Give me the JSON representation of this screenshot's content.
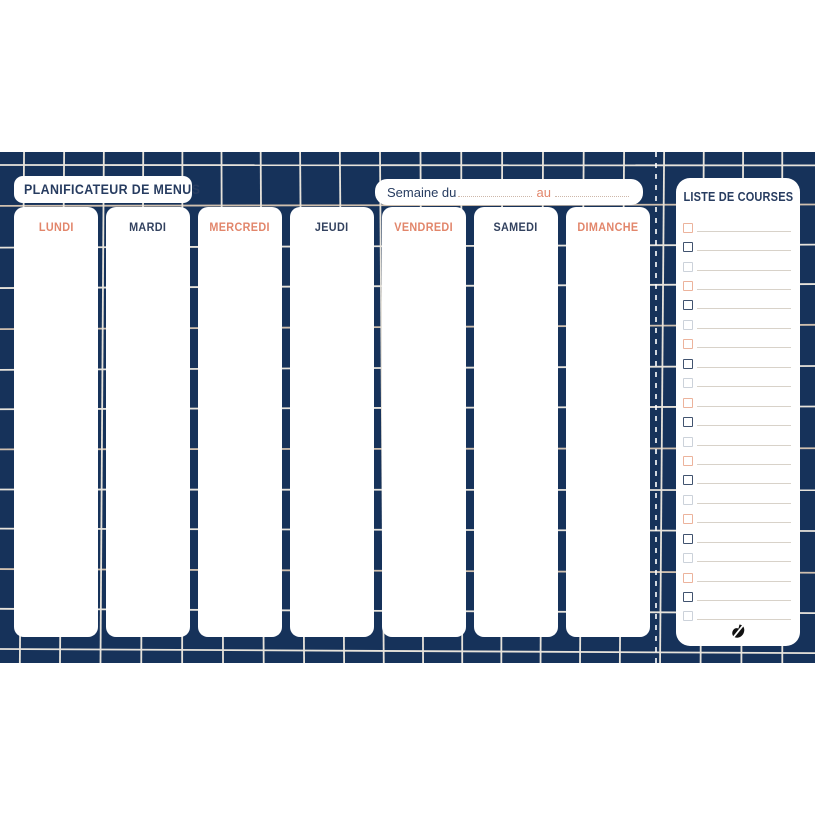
{
  "header": {
    "title": "PLANIFICATEUR DE MENUS",
    "week_field": {
      "label": "Semaine du",
      "separator": "au",
      "from_value": "",
      "to_value": ""
    }
  },
  "days": [
    {
      "label": "LUNDI",
      "label_color": "coral"
    },
    {
      "label": "MARDI",
      "label_color": "navy"
    },
    {
      "label": "MERCREDI",
      "label_color": "coral"
    },
    {
      "label": "JEUDI",
      "label_color": "navy"
    },
    {
      "label": "VENDREDI",
      "label_color": "coral"
    },
    {
      "label": "SAMEDI",
      "label_color": "navy"
    },
    {
      "label": "DIMANCHE",
      "label_color": "coral"
    }
  ],
  "shopping_list": {
    "title": "LISTE DE COURSES",
    "row_count": 21,
    "checkbox_color_cycle": [
      "coral",
      "navy",
      "pale"
    ],
    "logo_icon": "brand-swoosh-icon"
  },
  "colors": {
    "background_navy": "#16325a",
    "text_navy": "#273c60",
    "coral": "#e2866b",
    "checkbox_coral": "#ecb39c",
    "checkbox_navy": "#41536f",
    "checkbox_pale": "#ccd2da",
    "guide_line": "#d8d2c9",
    "grid_line_light": "#e7e3db",
    "grid_line_warm": "#cfbfae"
  }
}
